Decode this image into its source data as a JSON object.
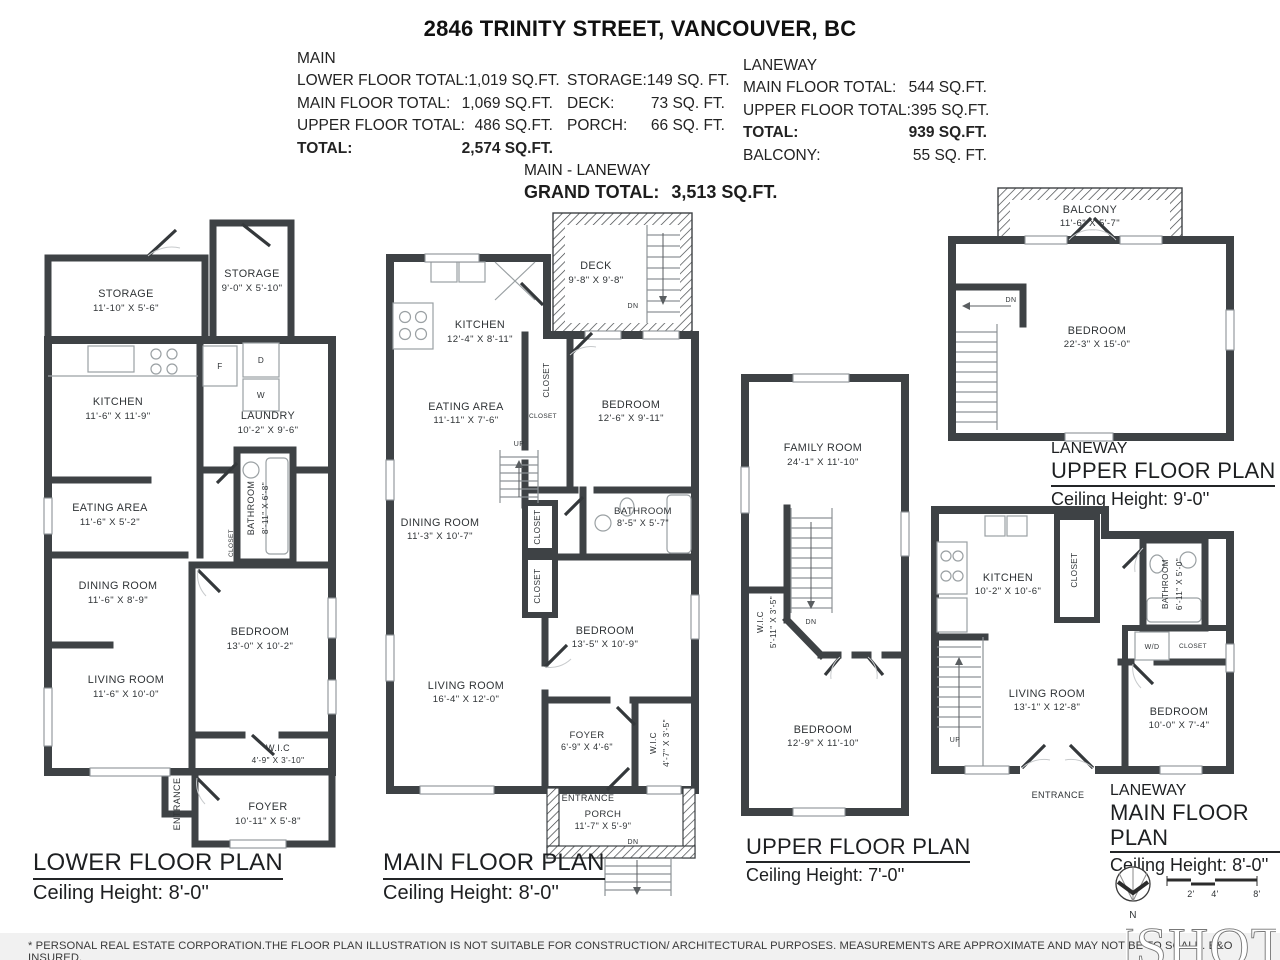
{
  "header": {
    "title": "2846 TRINITY STREET, VANCOUVER, BC"
  },
  "summary": {
    "main": {
      "heading": "MAIN",
      "rows": [
        {
          "label": "LOWER FLOOR TOTAL:",
          "value": "1,019 SQ.FT."
        },
        {
          "label": "MAIN FLOOR TOTAL:",
          "value": "1,069 SQ.FT."
        },
        {
          "label": "UPPER FLOOR TOTAL:",
          "value": "486 SQ.FT."
        },
        {
          "label": "TOTAL:",
          "value": "2,574 SQ.FT."
        }
      ],
      "extras": [
        {
          "label": "STORAGE:",
          "value": "149 SQ. FT."
        },
        {
          "label": "DECK:",
          "value": "73 SQ. FT."
        },
        {
          "label": "PORCH:",
          "value": "66 SQ. FT."
        }
      ]
    },
    "laneway": {
      "heading": "LANEWAY",
      "rows": [
        {
          "label": "MAIN FLOOR TOTAL:",
          "value": "544 SQ.FT."
        },
        {
          "label": "UPPER FLOOR TOTAL:",
          "value": "395 SQ.FT."
        },
        {
          "label": "TOTAL:",
          "value": "939 SQ.FT."
        },
        {
          "label": "BALCONY:",
          "value": "55 SQ. FT."
        }
      ]
    },
    "grand": {
      "line1": "MAIN - LANEWAY",
      "label": "GRAND TOTAL:",
      "value": "3,513 SQ.FT."
    }
  },
  "plans": {
    "lower": {
      "caption": {
        "title": "LOWER FLOOR PLAN",
        "ceiling": "Ceiling Height: 8'-0''"
      },
      "rooms": {
        "storage1": {
          "name": "STORAGE",
          "dims": "11'-10\" X 5'-6\""
        },
        "storage2": {
          "name": "STORAGE",
          "dims": "9'-0\" X 5'-10\""
        },
        "kitchen": {
          "name": "KITCHEN",
          "dims": "11'-6\" X 11'-9\""
        },
        "laundry": {
          "name": "LAUNDRY",
          "dims": "10'-2\" X 9'-6\""
        },
        "bathroom": {
          "name": "BATHROOM",
          "dims": "8'-11\" X 6'-8\""
        },
        "eating": {
          "name": "EATING AREA",
          "dims": "11'-6\" X 5'-2\""
        },
        "dining": {
          "name": "DINING ROOM",
          "dims": "11'-6\" X 8'-9\""
        },
        "bedroom": {
          "name": "BEDROOM",
          "dims": "13'-0\" X 10'-2\""
        },
        "living": {
          "name": "LIVING ROOM",
          "dims": "11'-6\" X 10'-0\""
        },
        "wic": {
          "name": "W.I.C",
          "dims": "4'-9\" X 3'-10\""
        },
        "foyer": {
          "name": "FOYER",
          "dims": "10'-11\" X 5'-8\""
        }
      },
      "labels": {
        "entrance": "ENTRANCE",
        "closet": "CLOSET",
        "fridge": "F",
        "dryer": "D",
        "washer": "W"
      }
    },
    "main": {
      "caption": {
        "title": "MAIN FLOOR PLAN",
        "ceiling": "Ceiling Height: 8'-0''"
      },
      "rooms": {
        "deck": {
          "name": "DECK",
          "dims": "9'-8\" X 9'-8\""
        },
        "kitchen": {
          "name": "KITCHEN",
          "dims": "12'-4\" X 8'-11\""
        },
        "eating": {
          "name": "EATING AREA",
          "dims": "11'-11\" X 7'-6\""
        },
        "bedroom1": {
          "name": "BEDROOM",
          "dims": "12'-6\" X 9'-11\""
        },
        "dining": {
          "name": "DINING ROOM",
          "dims": "11'-3\" X 10'-7\""
        },
        "bathroom": {
          "name": "BATHROOM",
          "dims": "8'-5\" X 5'-7\""
        },
        "bedroom2": {
          "name": "BEDROOM",
          "dims": "13'-5\" X 10'-9\""
        },
        "living": {
          "name": "LIVING ROOM",
          "dims": "16'-4\" X 12'-0\""
        },
        "foyer": {
          "name": "FOYER",
          "dims": "6'-9\" X 4'-6\""
        },
        "wic": {
          "name": "W.I.C",
          "dims": "4'-7\" X 3'-5\""
        },
        "porch": {
          "name": "PORCH",
          "dims": "11'-7\" X 5'-9\""
        }
      },
      "labels": {
        "closet": "CLOSET",
        "entrance": "ENTRANCE",
        "up": "UP",
        "dn": "DN"
      }
    },
    "upper": {
      "caption": {
        "title": "UPPER FLOOR PLAN",
        "ceiling": "Ceiling Height: 7'-0''"
      },
      "rooms": {
        "family": {
          "name": "FAMILY ROOM",
          "dims": "24'-1\" X 11'-10\""
        },
        "wic": {
          "name": "W.I.C",
          "dims": "5'-11\" X 3'-5\""
        },
        "bedroom": {
          "name": "BEDROOM",
          "dims": "12'-9\" X 11'-10\""
        }
      },
      "labels": {
        "dn": "DN"
      }
    },
    "laneway_upper": {
      "caption": {
        "tag": "LANEWAY",
        "title": "UPPER FLOOR PLAN",
        "ceiling": "Ceiling Height: 9'-0''"
      },
      "rooms": {
        "balcony": {
          "name": "BALCONY",
          "dims": "11'-6\" X 5'-7\""
        },
        "bedroom": {
          "name": "BEDROOM",
          "dims": "22'-3\" X 15'-0\""
        }
      },
      "labels": {
        "dn": "DN"
      }
    },
    "laneway_main": {
      "caption": {
        "tag": "LANEWAY",
        "title": "MAIN FLOOR PLAN",
        "ceiling": "Ceiling Height: 8'-0''"
      },
      "rooms": {
        "kitchen": {
          "name": "KITCHEN",
          "dims": "10'-2\" X 10'-6\""
        },
        "bathroom": {
          "name": "BATHROOM",
          "dims": "6'-11\" X 5'-0\""
        },
        "living": {
          "name": "LIVING ROOM",
          "dims": "13'-1\" X 12'-8\""
        },
        "bedroom": {
          "name": "BEDROOM",
          "dims": "10'-0\" X 7'-4\""
        }
      },
      "labels": {
        "closet": "CLOSET",
        "wd": "W/D",
        "up": "UP",
        "entrance": "ENTRANCE"
      }
    }
  },
  "footer": {
    "disclaimer": "* PERSONAL REAL ESTATE CORPORATION.THE FLOOR PLAN ILLUSTRATION IS NOT SUITABLE FOR CONSTRUCTION/ ARCHITECTURAL PURPOSES. MEASUREMENTS ARE APPROXIMATE AND MAY NOT BE TO SCALE. E&O INSURED.",
    "compass": "N",
    "scale_labels": [
      "2'",
      "4'",
      "8'"
    ],
    "logo": "ISHOT"
  }
}
